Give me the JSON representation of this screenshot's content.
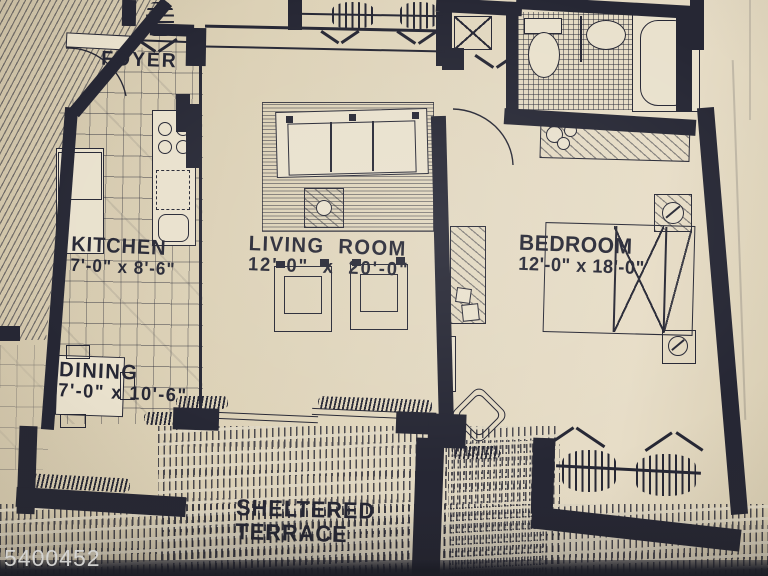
{
  "labels": {
    "foyer": "FOYER",
    "kitchen_name": "KITCHEN",
    "kitchen_dims": "7'-0\" x 8'-6\"",
    "living_name": "LIVING ROOM",
    "living_dims": "12'-0\" x 20'-0\"",
    "dining_name": "DINING",
    "dining_dims": "7'-0\" x 10'-6\"",
    "bedroom_name": "BEDROOM",
    "bedroom_dims": "12'-0\" x 18'-0\"",
    "terrace_line1": "SHELTERED",
    "terrace_line2": "TERRACE",
    "watermark": "5400452"
  },
  "colors": {
    "paper": "#ddd2b8",
    "ink": "#262734",
    "watermark": "#d8d8d6"
  }
}
